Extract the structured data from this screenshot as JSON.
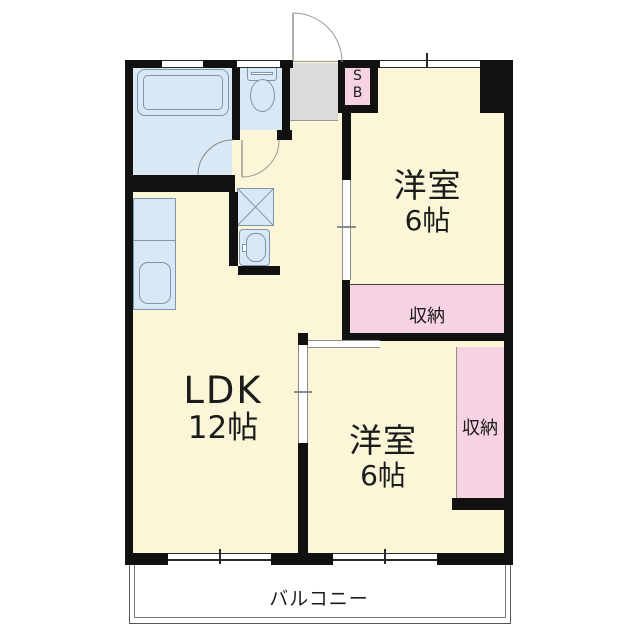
{
  "rooms": {
    "western_top": {
      "name": "洋室",
      "size": "6帖"
    },
    "western_bottom": {
      "name": "洋室",
      "size": "6帖"
    },
    "ldk": {
      "name": "LDK",
      "size": "12帖"
    },
    "storage_top": {
      "label": "収納"
    },
    "storage_right": {
      "label": "収納"
    },
    "balcony": {
      "label": "バルコニー"
    },
    "shoe_box": {
      "line1": "S",
      "line2": "B"
    }
  },
  "icons": {
    "bathtub-icon": "bathtub",
    "toilet-icon": "toilet",
    "kitchen-counter": "kitchen counter with sink",
    "washing-machine-pan-icon": "washing machine pan (crossed box)",
    "wash-basin-icon": "wash basin",
    "entrance-door-arc-icon": "entrance door swing arc",
    "bathroom-door-arc-icon": "bathroom door swing arc",
    "toilet-door-arc-icon": "toilet door swing arc",
    "window-line": "window shown as thin double line in wall"
  },
  "colors": {
    "wall": "#111111",
    "room_fill": "#FAF6D7",
    "storage_fill": "#F7D2E2",
    "wet_fill": "#D9E8F5",
    "entrance_fill": "#DCDCDC",
    "fixture_line": "#7D96AD",
    "line_thin": "#8B8B8B",
    "text": "#1C1C1C"
  }
}
